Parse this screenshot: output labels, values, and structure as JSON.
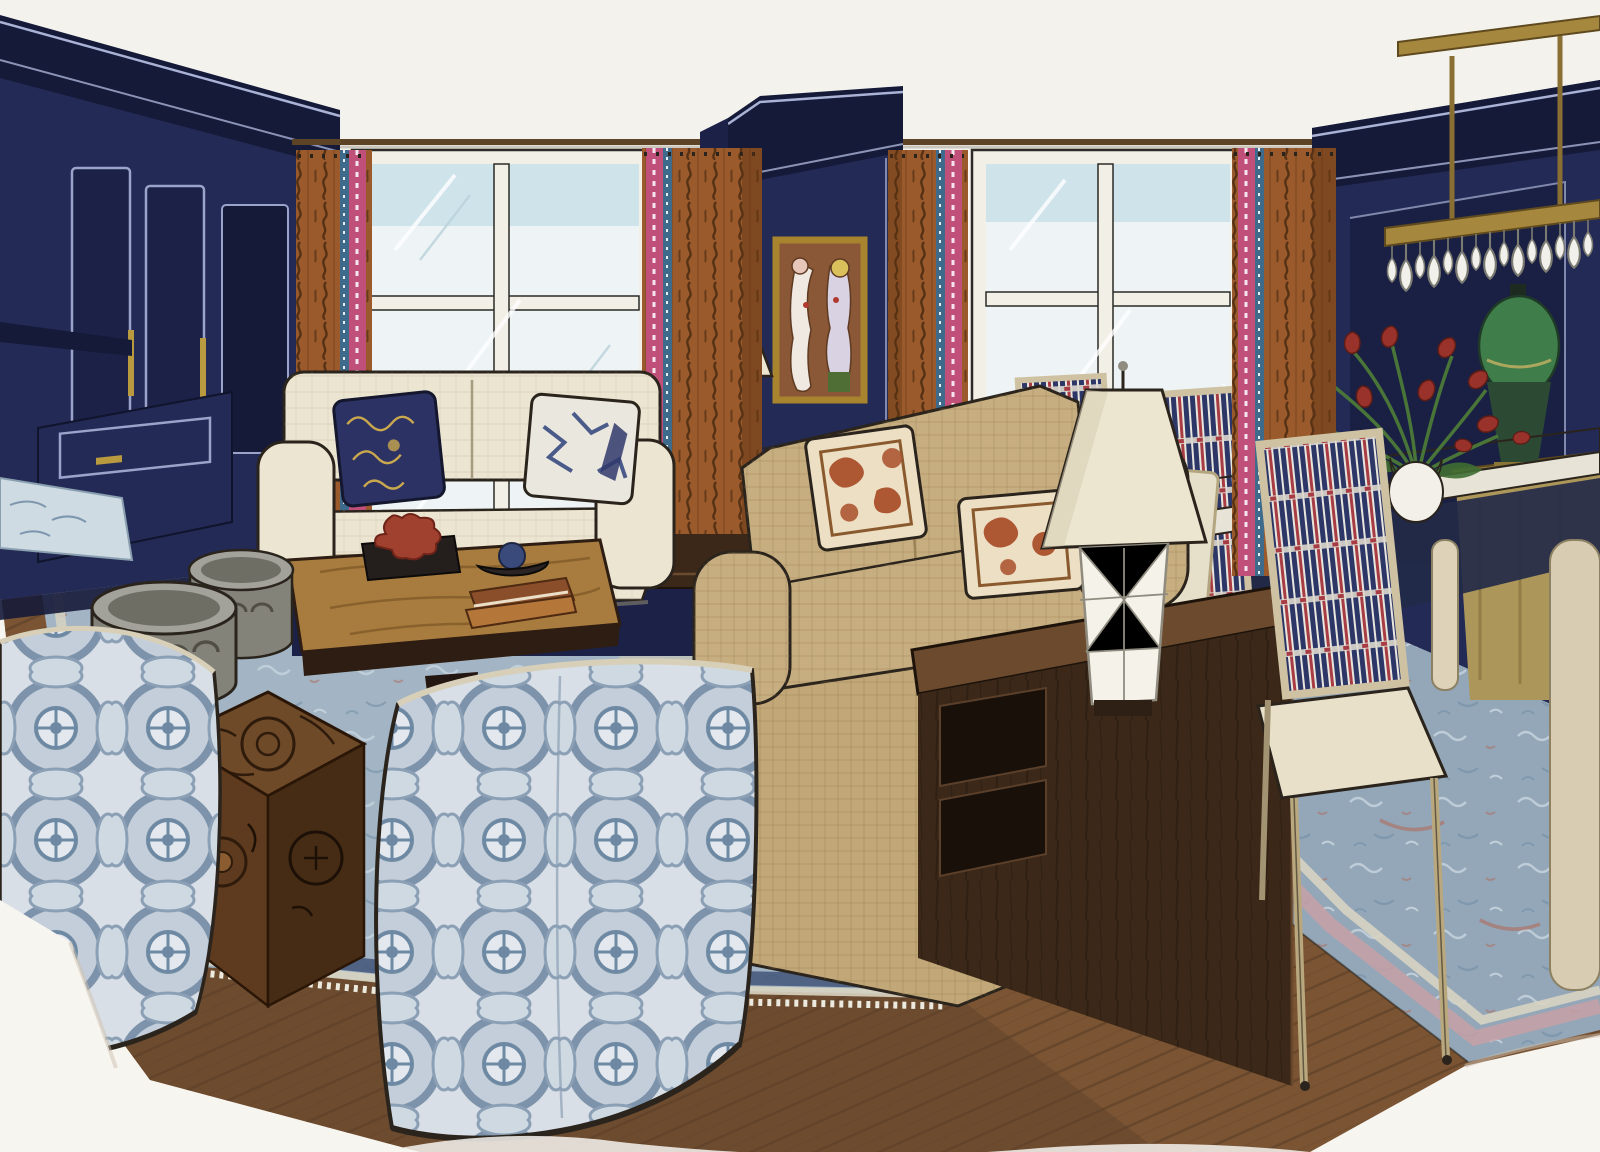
{
  "meta": {
    "kind": "hand-drawn interior design rendering (marker and ink on paper)",
    "scene": "living room and dining area with navy paneled walls, two windows with rust curtains, cream and tan sofas, blue medallion barrel chairs, walnut media console with faceted lamp, dining table with tulip centerpiece, brass crystal chandelier, layered blue rugs on dark wood floor",
    "visible_text": ""
  },
  "palette": {
    "paper": "#f7f5f0",
    "ceiling": "#f3f2ed",
    "ink": "#2a241d",
    "navy": "#232a56",
    "navyDeep": "#151a38",
    "navyPanel": "#1b2147",
    "navyLine": "#aab3d6",
    "taupe": "#b3a78f",
    "screen": "#17171c",
    "rust": "#9a5a2c",
    "rustDeep": "#5e3414",
    "trimPink": "#c0507a",
    "trimBlue": "#3e6a8c",
    "glass": "#eef4f5",
    "sky": "#cfe3eb",
    "frameWhite": "#f2efe7",
    "cream": "#ece5d2",
    "creamShadow": "#cfc4a9",
    "tan": "#c7ae80",
    "tanShadow": "#a08758",
    "rugField": "#a3b5c4",
    "rugField2": "#93a7b8",
    "rugBorder": "#d8d4c2",
    "rugBlue": "#5f7d99",
    "rugRed": "#b06a5a",
    "floor": "#7b5433",
    "floorLine": "#543a23",
    "walnut": "#3b2818",
    "walnutTop": "#6b4a2e",
    "coffeeTop": "#a87c3e",
    "carved": "#6e4a28",
    "carvedDark": "#462c15",
    "ottoman": "#84837a",
    "ottomanTop": "#a3a29a",
    "ottomanDark": "#514f45",
    "fabricGround": "#d9dfe6",
    "fabricBlue": "#7d93ab",
    "fabricDeep": "#6d89a3",
    "shade": "#ece5cf",
    "porcelain": "#f5f2e9",
    "brass": "#a5873e",
    "brassDeep": "#5e4a1e",
    "gold": "#ac9659",
    "artGround": "#8a5836",
    "frameGold": "#a8842f",
    "leaf": "#4c7a38",
    "tulip": "#99322a",
    "pillowNavy": "#2c3263",
    "pillowGold": "#c9a84e",
    "pillowRust": "#ad5733",
    "pillowGround": "#ecdfc3",
    "chairStripeNavy": "#2c3768",
    "chairStripeRed": "#a83c44",
    "seatCream": "#e8e0c9",
    "greenLamp": "#3f7d4a",
    "greenLampDark": "#2c4a33",
    "underTable": "#232a48"
  },
  "objects": [
    {
      "id": "wall-left-cabinetry",
      "label": "navy built-in cabinetry with crown molding and brass pulls"
    },
    {
      "id": "tv-panel",
      "label": "dark flat panel on taupe wall strip"
    },
    {
      "id": "window-left",
      "label": "left window with white mullions"
    },
    {
      "id": "window-right",
      "label": "right window with white mullions"
    },
    {
      "id": "curtains",
      "label": "rust drapery panels with pink and blue trim tape"
    },
    {
      "id": "pillar-artwork",
      "label": "framed abstract figure painting on navy pillar"
    },
    {
      "id": "sofa-cream",
      "label": "cream sofa with navy and white patterned pillows"
    },
    {
      "id": "sofa-tan",
      "label": "tan sofa with rust patterned pillows"
    },
    {
      "id": "coffee-table",
      "label": "burl-top coffee table with coral, books and bowl"
    },
    {
      "id": "ottomans",
      "label": "two gray carved drum ottomans"
    },
    {
      "id": "side-table-carved",
      "label": "carved wood cube side table"
    },
    {
      "id": "barrel-chairs",
      "label": "blue medallion-print barrel swivel chairs"
    },
    {
      "id": "console-walnut",
      "label": "dark walnut media console"
    },
    {
      "id": "lamp-faceted",
      "label": "white faceted table lamp with cream shade"
    },
    {
      "id": "lamp-small",
      "label": "small faceted lamp on end table"
    },
    {
      "id": "end-table",
      "label": "dark wood end table"
    },
    {
      "id": "dining-table",
      "label": "white dining table"
    },
    {
      "id": "dining-chairs",
      "label": "cream dining chairs with striped ikat backs"
    },
    {
      "id": "tulip-centerpiece",
      "label": "white vase with red tulips"
    },
    {
      "id": "chandelier",
      "label": "brass linear chandelier with crystal drops"
    },
    {
      "id": "lamp-green-urn",
      "label": "green urn lamp on gold console"
    },
    {
      "id": "rug-living",
      "label": "blue oriental rug with fringe"
    },
    {
      "id": "rug-dining",
      "label": "blue and rose dining rug"
    },
    {
      "id": "wood-floor",
      "label": "dark stained plank floor fading to raw paper"
    }
  ]
}
